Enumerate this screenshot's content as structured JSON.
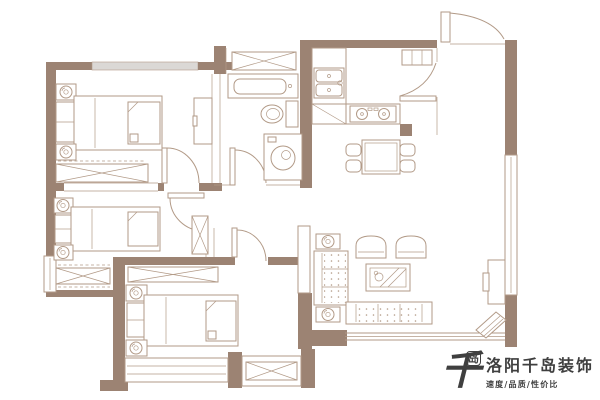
{
  "branding": {
    "mark_main": "千",
    "mark_sub": "岛",
    "company": "洛阳千岛装饰",
    "tagline": "速度/品质/性价比"
  },
  "palette": {
    "wall": "#9c8373",
    "line": "#b29a87",
    "window_gray": "#dbd8d5",
    "background": "#ffffff",
    "logo_text": "#3f3f3f"
  },
  "floorplan": {
    "type": "residential-floor-plan",
    "rooms": [
      "bedroom-1",
      "bedroom-2",
      "bedroom-3",
      "bathroom",
      "kitchen",
      "dining-area",
      "living-room",
      "entry-foyer",
      "bay-storage"
    ],
    "furniture_icons": [
      "bed-icon",
      "nightstand-flower-icon",
      "wardrobe-x-icon",
      "vanity-icon",
      "toilet-icon",
      "washing-machine-icon",
      "kitchen-sink-icon",
      "stove-icon",
      "fridge-icon",
      "dining-table-icon",
      "dining-chair-icon",
      "sofa-icon",
      "armchair-icon",
      "coffee-table-icon",
      "tv-cabinet-icon",
      "bay-window-icon",
      "door-arc-icon"
    ]
  }
}
